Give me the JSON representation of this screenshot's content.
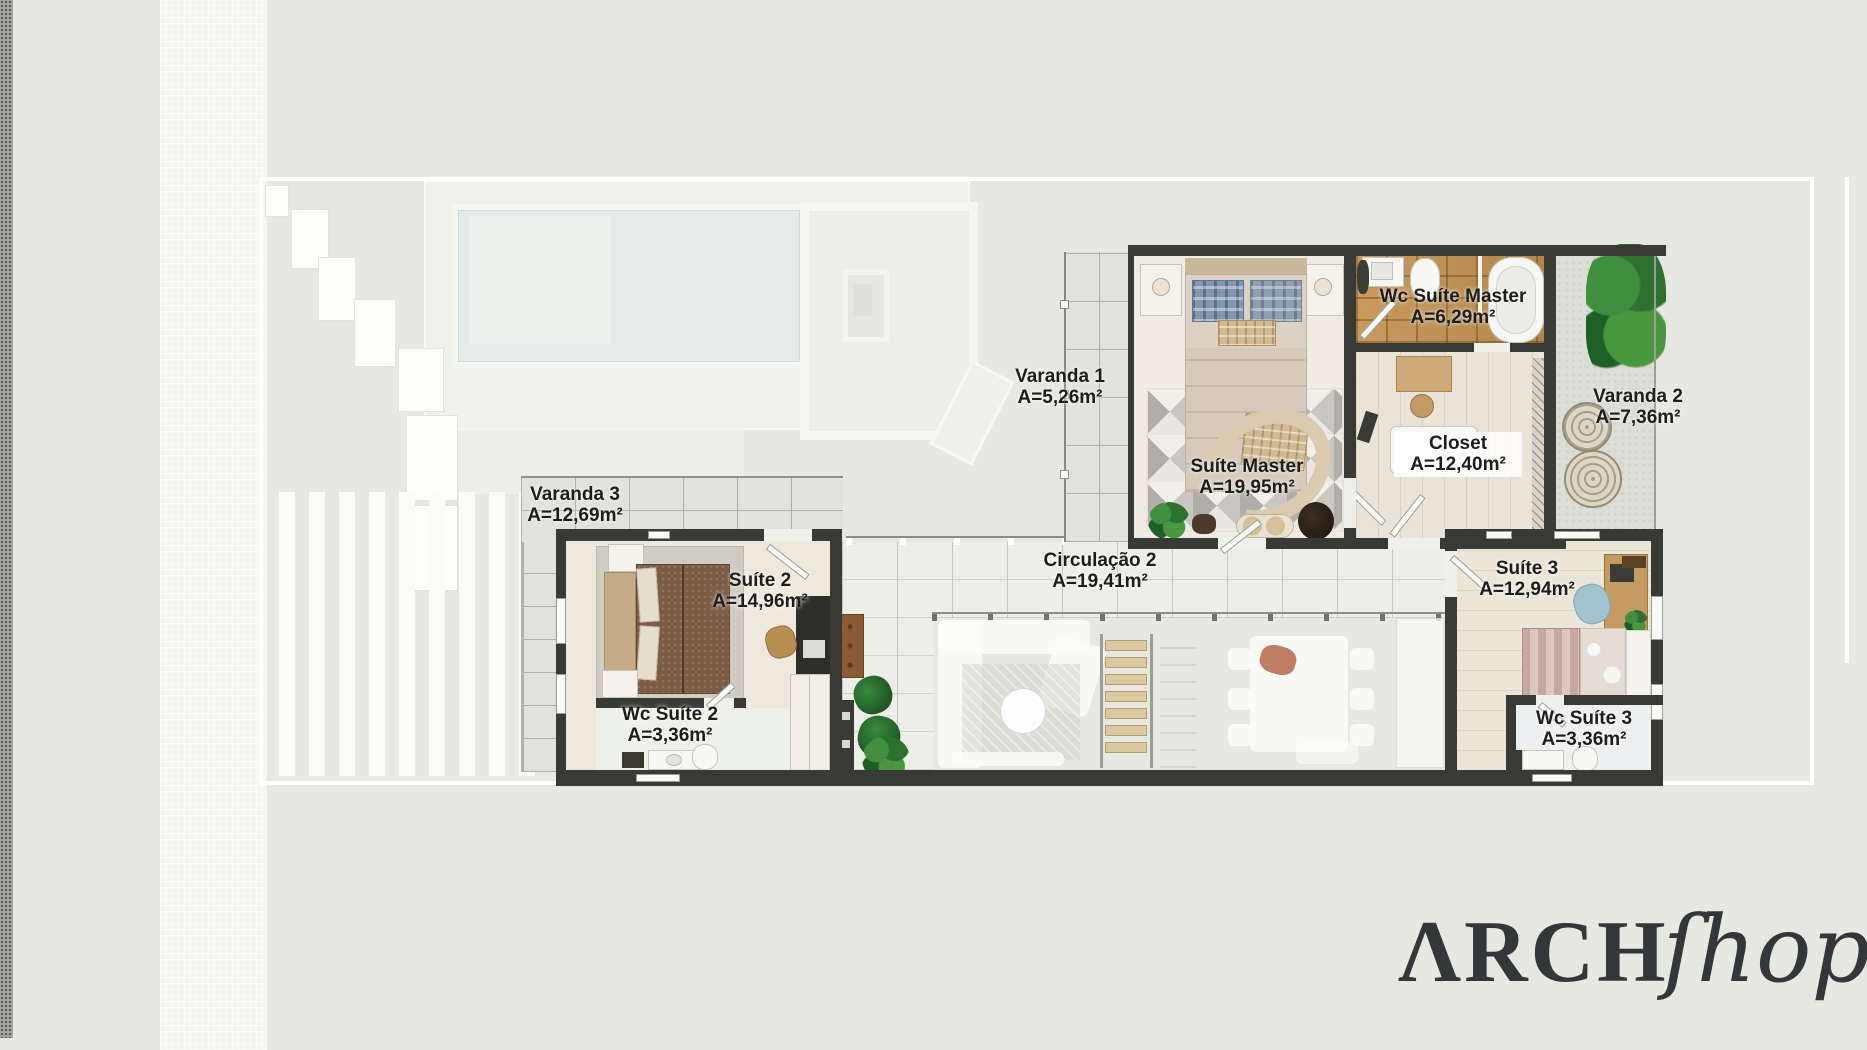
{
  "title": "Upper floor plan",
  "rooms": [
    {
      "id": "varanda1",
      "name": "Varanda 1",
      "area": "A=5,26m²"
    },
    {
      "id": "wc_suite_master",
      "name": "Wc Suíte Master",
      "area": "A=6,29m²"
    },
    {
      "id": "varanda2",
      "name": "Varanda 2",
      "area": "A=7,36m²"
    },
    {
      "id": "suite_master",
      "name": "Suíte Master",
      "area": "A=19,95m²"
    },
    {
      "id": "closet",
      "name": "Closet",
      "area": "A=12,40m²"
    },
    {
      "id": "varanda3",
      "name": "Varanda 3",
      "area": "A=12,69m²"
    },
    {
      "id": "suite2",
      "name": "Suíte 2",
      "area": "A=14,96m²"
    },
    {
      "id": "circulacao2",
      "name": "Circulação 2",
      "area": "A=19,41m²"
    },
    {
      "id": "suite3",
      "name": "Suíte 3",
      "area": "A=12,94m²"
    },
    {
      "id": "wc_suite2",
      "name": "Wc Suíte 2",
      "area": "A=3,36m²"
    },
    {
      "id": "wc_suite3",
      "name": "Wc Suíte 3",
      "area": "A=3,36m²"
    }
  ],
  "logo": {
    "serif": "ΛRCH",
    "script": "ſhop"
  },
  "colors": {
    "background": "#e7e8e1",
    "wall": "#393935",
    "bathroom_wood": "#c0945c",
    "pool": "#e3ece8",
    "tile": "#e0e2db",
    "plant_green": "#2e7d32",
    "logo_text": "#34373a",
    "label_text": "#1d1d1b"
  }
}
